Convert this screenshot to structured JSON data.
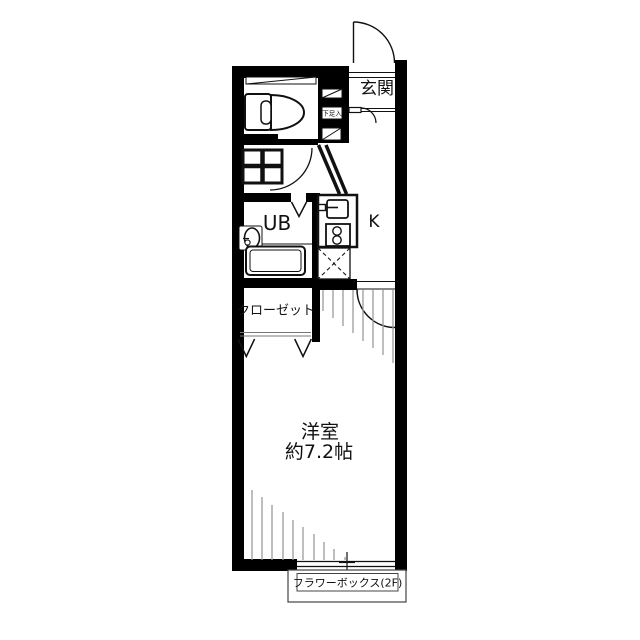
{
  "floorplan": {
    "title": "1K apartment floor plan",
    "labels": {
      "entrance": "玄関",
      "shoe_box": "下足入",
      "unit_bath": "UB",
      "kitchen": "K",
      "closet": "クローゼット",
      "room_name": "洋室",
      "room_size": "約7.2帖",
      "flower_box": "フラワーボックス(2F)"
    },
    "colors": {
      "wall": "#000000",
      "background": "#ffffff",
      "hatch": "#9a9a9a",
      "line": "#111111"
    }
  }
}
